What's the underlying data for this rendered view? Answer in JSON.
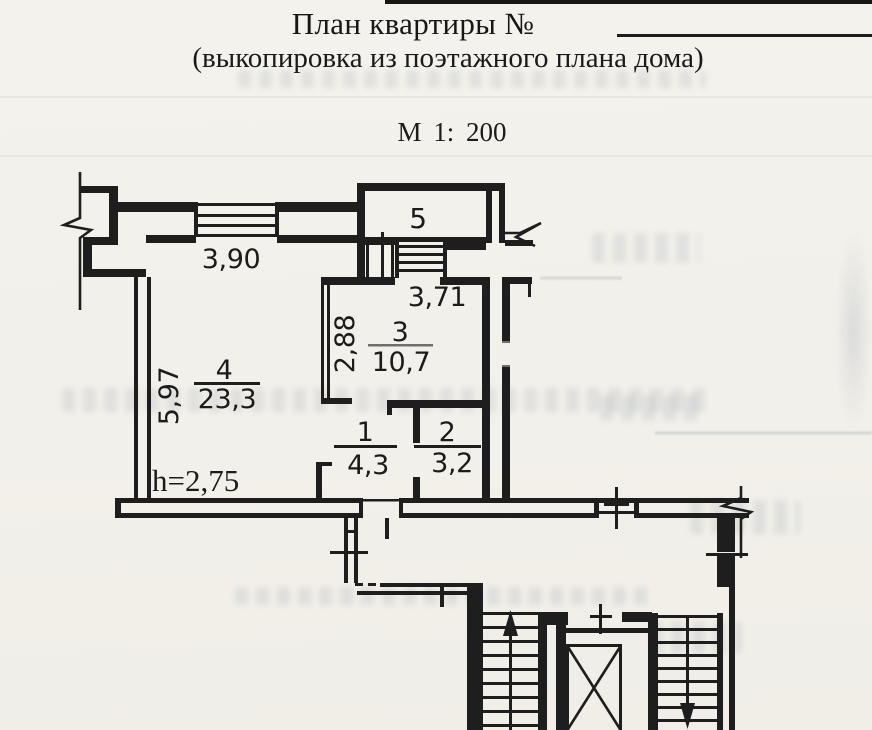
{
  "header": {
    "title": "План квартиры №",
    "subtitle": "(выкопировка из поэтажного плана дома)",
    "scale": "М 1: 200"
  },
  "plan": {
    "height_note": "h=2,75",
    "rooms": [
      {
        "number": "1",
        "area": "4,3"
      },
      {
        "number": "2",
        "area": "3,2"
      },
      {
        "number": "3",
        "area": "10,7"
      },
      {
        "number": "4",
        "area": "23,3"
      },
      {
        "number": "5",
        "area": ""
      }
    ],
    "dimensions": {
      "top_window": "3,90",
      "kitchen_width": "3,71",
      "kitchen_depth": "2,88",
      "living_depth": "5,97"
    }
  },
  "colors": {
    "ink": "#1e1e1e",
    "paper": "#f2f0ea"
  }
}
